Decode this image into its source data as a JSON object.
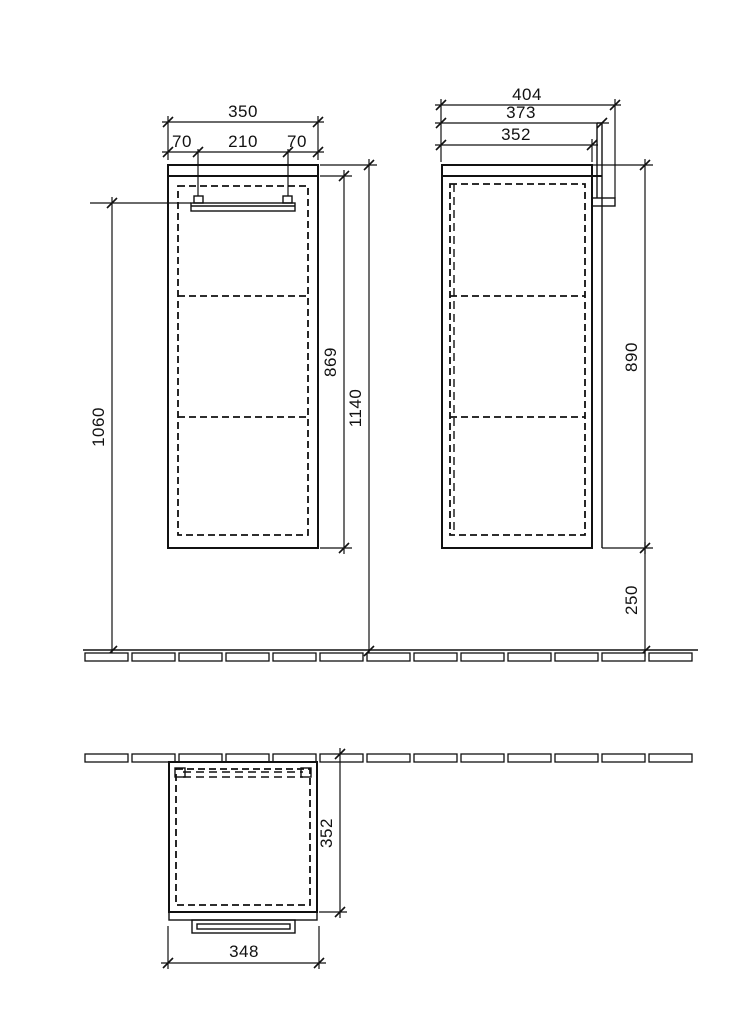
{
  "drawing": {
    "kind": "furniture cabinet technical drawing",
    "front": {
      "total_width": "350",
      "left_offset": "70",
      "handle_width": "210",
      "right_offset": "70",
      "handle_height_from_floor": "1060",
      "body_height": "869",
      "total_height_from_floor": "1140"
    },
    "side": {
      "total_depth": "404",
      "rail_depth": "373",
      "body_depth": "352",
      "body_height": "890",
      "bottom_clearance": "250"
    },
    "top": {
      "body_depth": "352",
      "front_width": "348"
    }
  }
}
